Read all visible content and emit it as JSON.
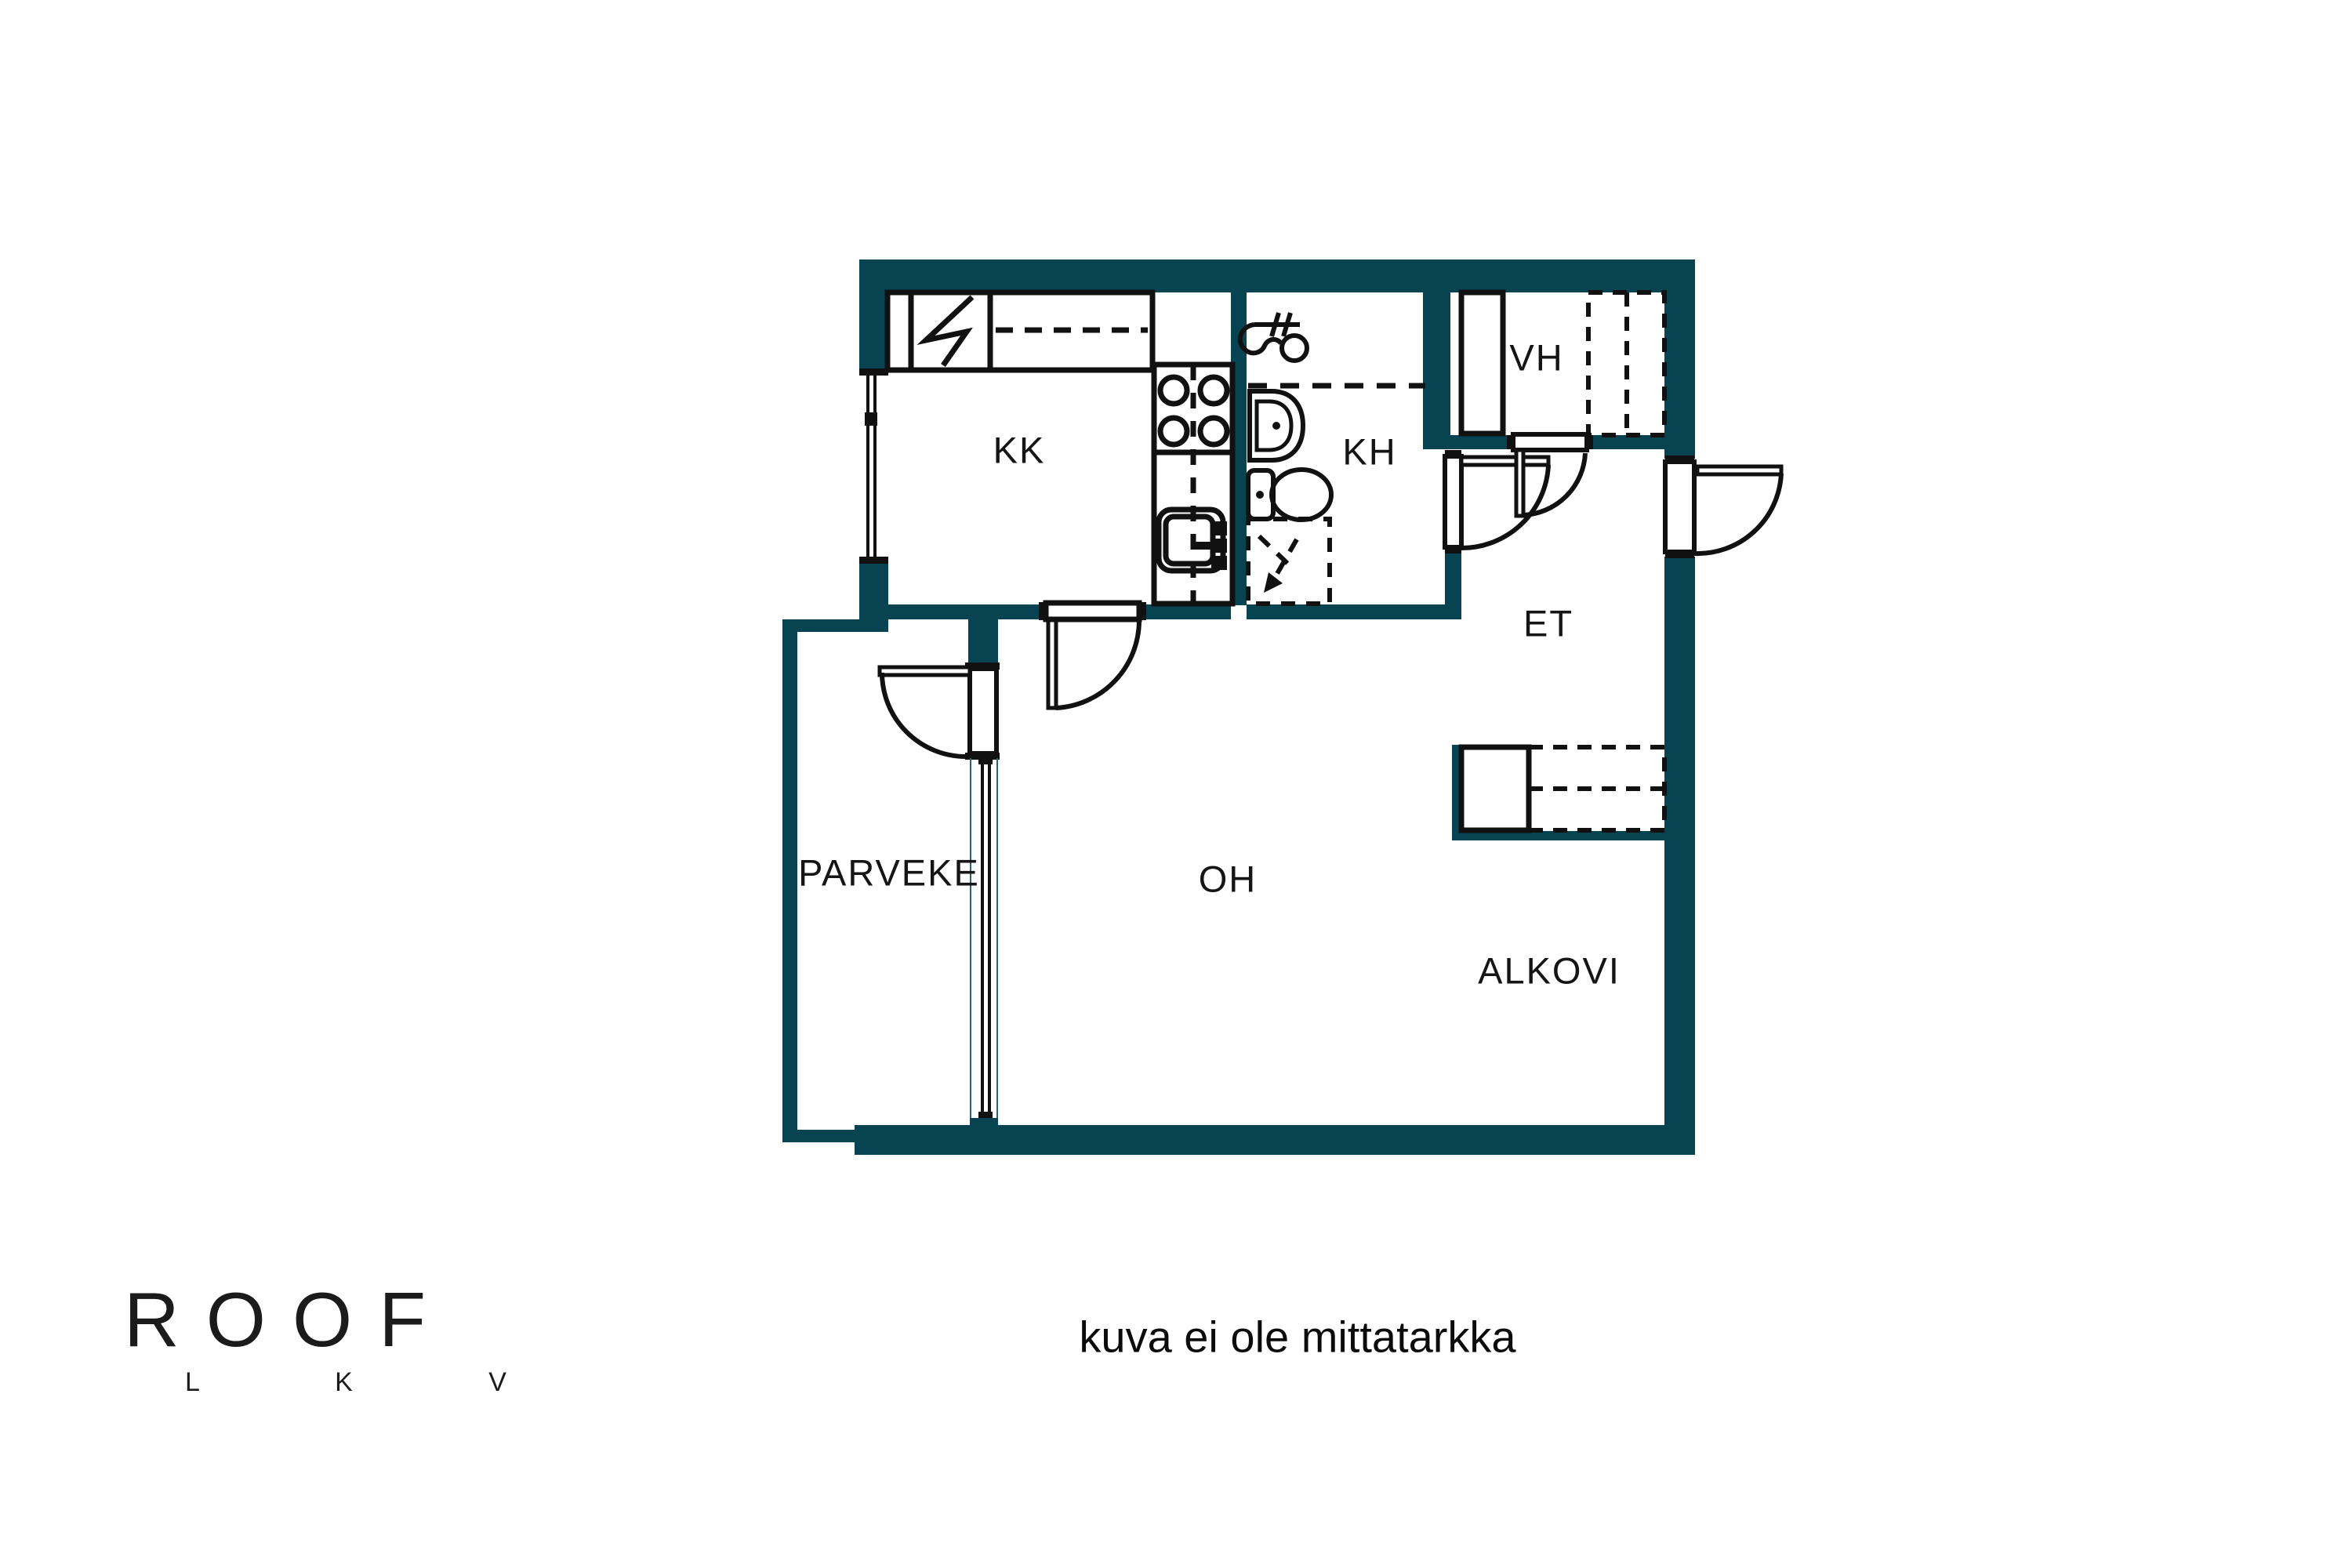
{
  "title": "apartment floor plan",
  "caption": "kuva ei ole mittatarkka",
  "logo": {
    "brand": "ROOF",
    "sub": "L K V"
  },
  "colors": {
    "wall": "#084352",
    "line": "#111111",
    "background": "#ffffff"
  },
  "rooms": [
    {
      "id": "kk",
      "label": "KK"
    },
    {
      "id": "kh",
      "label": "KH"
    },
    {
      "id": "vh",
      "label": "VH"
    },
    {
      "id": "et",
      "label": "ET"
    },
    {
      "id": "oh",
      "label": "OH"
    },
    {
      "id": "alkovi",
      "label": "ALKOVI"
    },
    {
      "id": "parveke",
      "label": "PARVEKE"
    }
  ],
  "fixtures": [
    "fridge-zigzag-icon",
    "upper-cabinet-dashed",
    "stove-burners-icon",
    "kitchen-sink-icon",
    "shower-mixer-icon",
    "washbasin-icon",
    "toilet-icon",
    "washing-machine-reservation-icon",
    "wardrobe-solid",
    "wardrobe-dashed",
    "door-swing",
    "window"
  ]
}
